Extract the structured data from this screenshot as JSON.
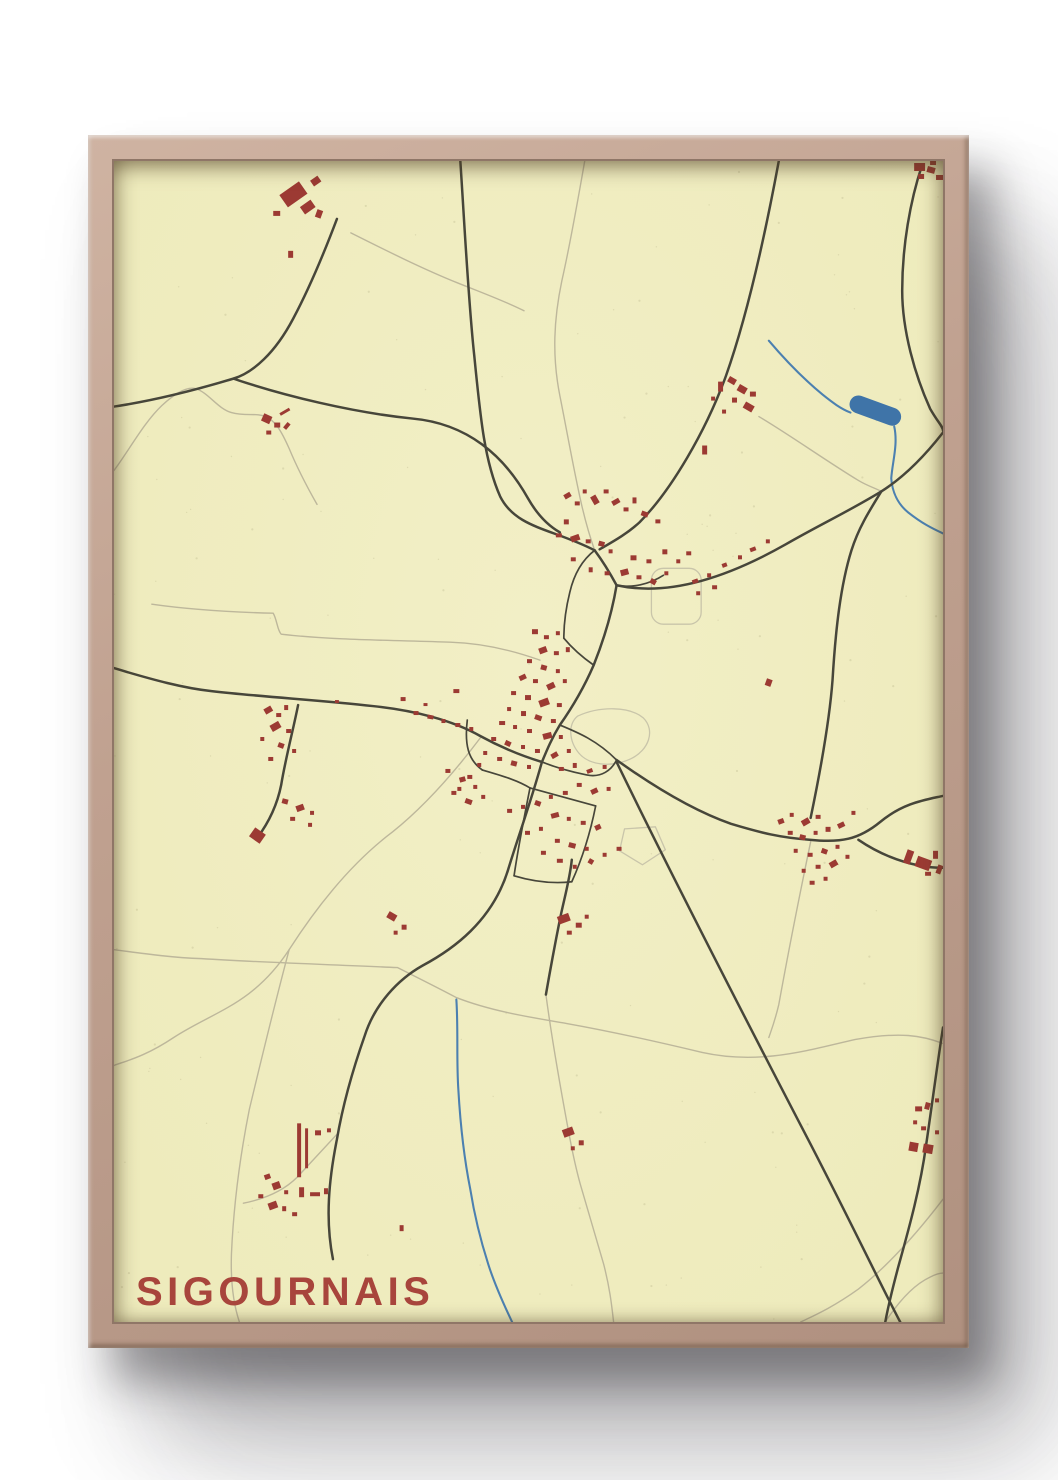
{
  "poster": {
    "title": "SIGOURNAIS",
    "colors": {
      "background": "#ffffff",
      "paper": "#f2efc6",
      "title_text": "#a8453c",
      "building": "#9c3a33",
      "road_major": "#47463a",
      "road_minor": "#bdb79b",
      "water_line": "#4c80b0",
      "water_fill": "#3f74a8",
      "frame_wood": "#c0a190",
      "enclosure": "#c9c5aa",
      "speckle": "#8c8460"
    }
  }
}
